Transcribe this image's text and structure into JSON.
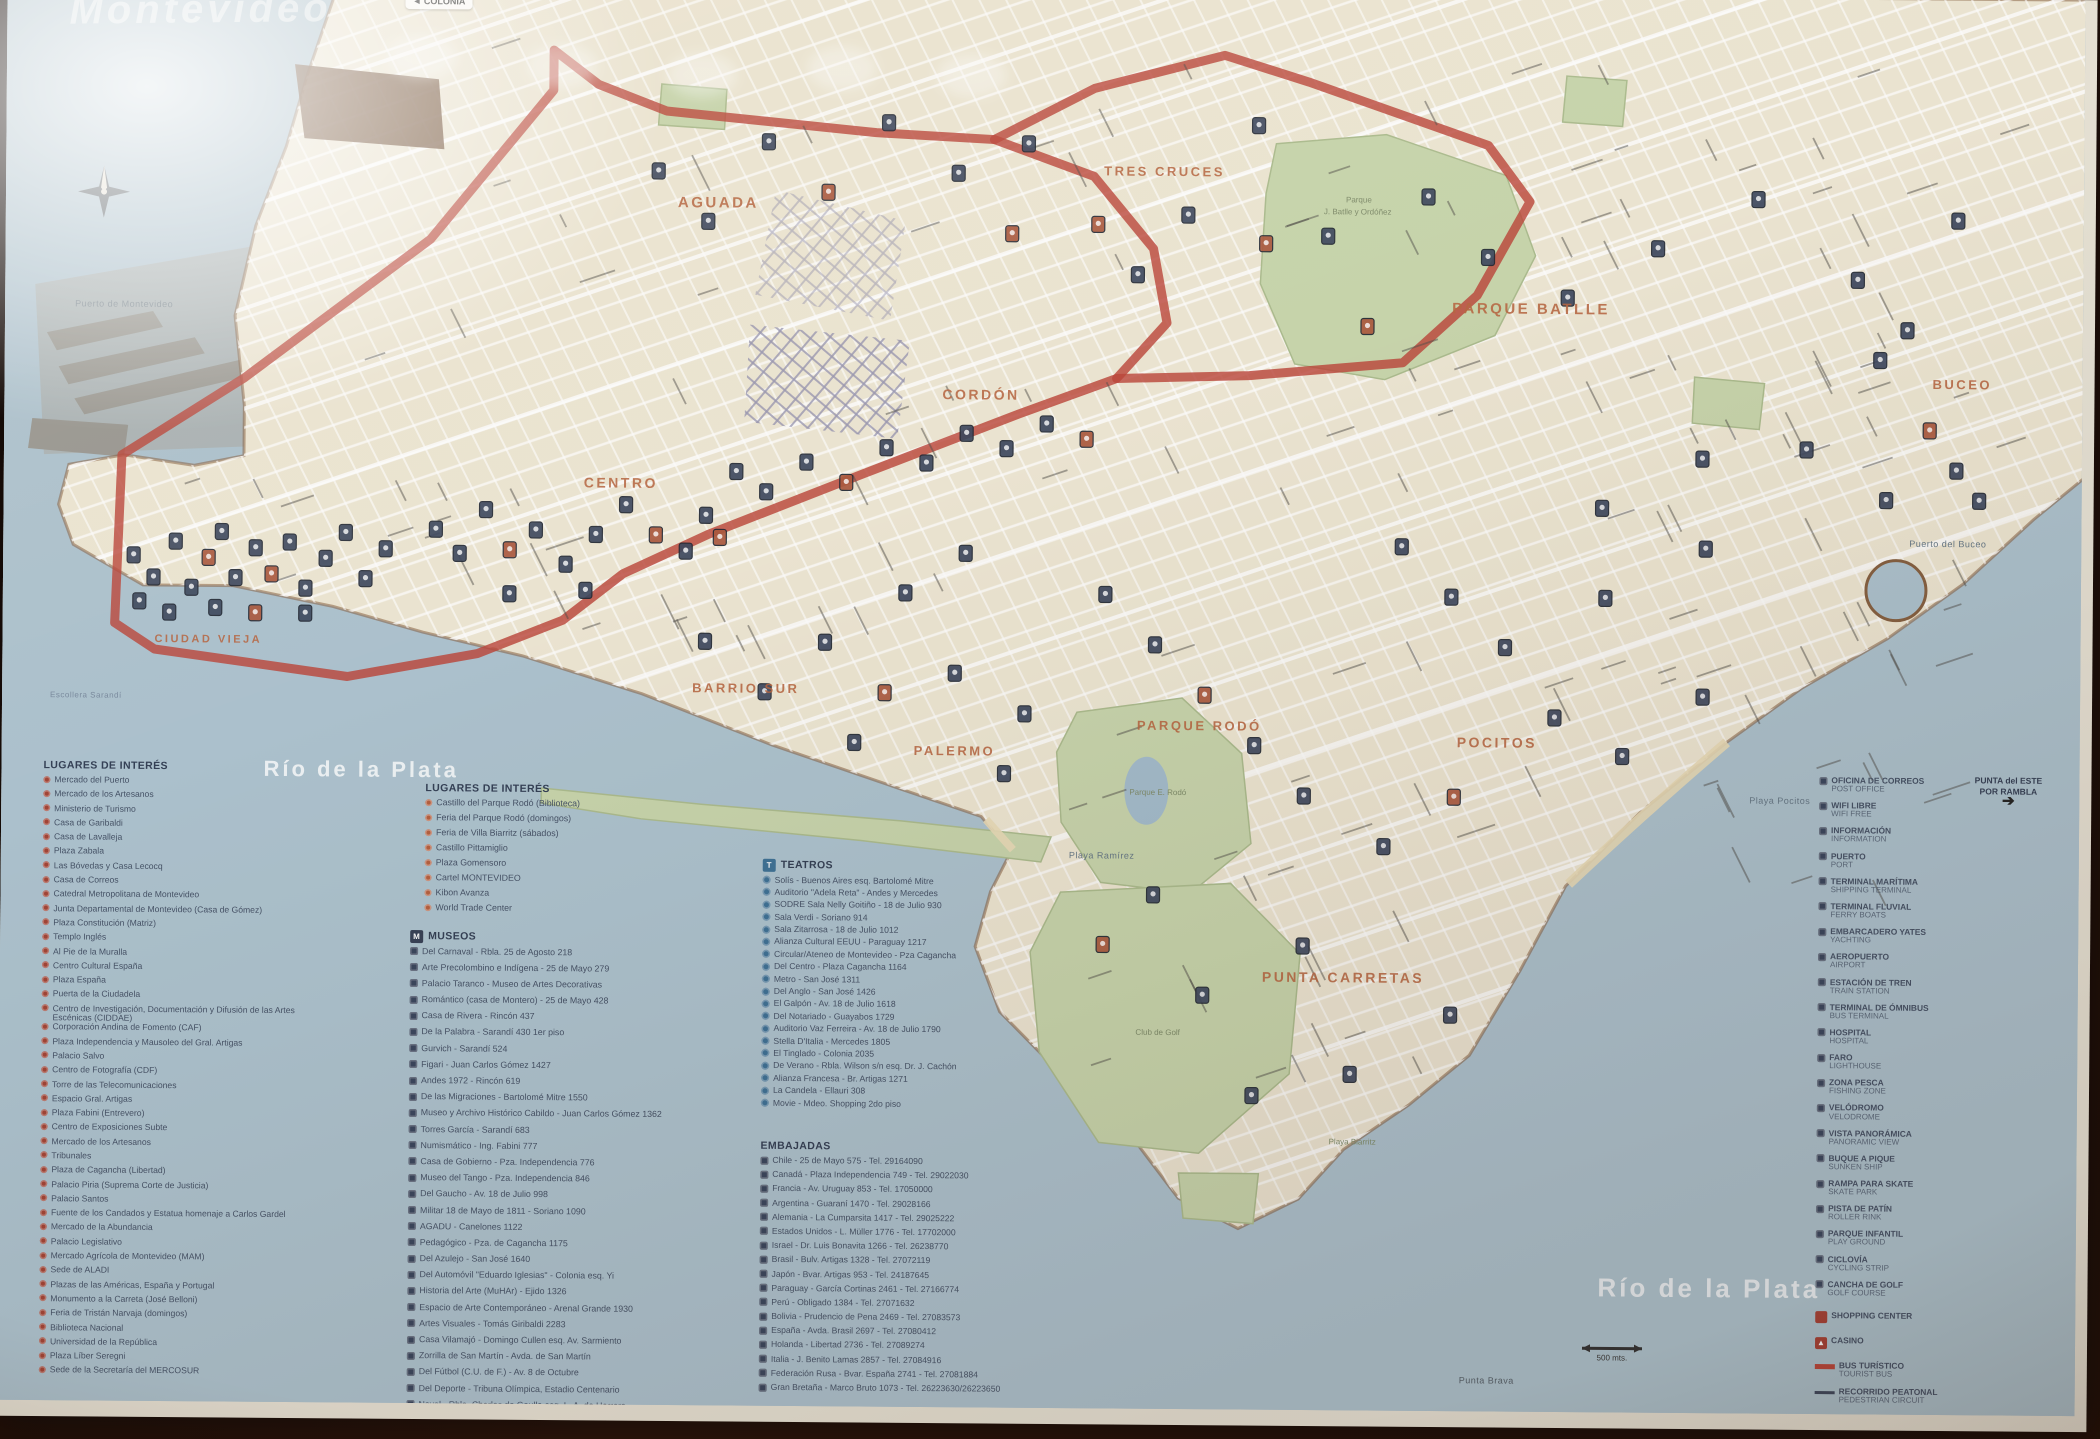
{
  "map": {
    "watermark": "Montevideo",
    "colonia_sign": "◄ COLONIA",
    "corner_note": {
      "line1": "PUNTA del ESTE",
      "line2": "POR RAMBLA",
      "arrow": "➔"
    },
    "scale_label": "500 mts.",
    "route_color": "#cf3a2c",
    "water_color": "#a7c2d1",
    "land_color": "#efe6cd",
    "park_color": "#c5d6a2",
    "district_color": "#c55f30",
    "districts": [
      {
        "text": "AGUADA",
        "x": 672,
        "y": 218,
        "size": 15
      },
      {
        "text": "TRES CRUCES",
        "x": 1098,
        "y": 183,
        "size": 13
      },
      {
        "text": "PARQUE BATLLE",
        "x": 1447,
        "y": 318,
        "size": 15
      },
      {
        "text": "CORDÓN",
        "x": 938,
        "y": 408,
        "size": 14
      },
      {
        "text": "CENTRO",
        "x": 580,
        "y": 499,
        "size": 14
      },
      {
        "text": "CIUDAD VIEJA",
        "x": 152,
        "y": 657,
        "size": 11
      },
      {
        "text": "BARRIO SUR",
        "x": 690,
        "y": 703,
        "size": 13
      },
      {
        "text": "PALERMO",
        "x": 912,
        "y": 764,
        "size": 13
      },
      {
        "text": "PARQUE RODÓ",
        "x": 1135,
        "y": 737,
        "size": 13
      },
      {
        "text": "PUNTA CARRETAS",
        "x": 1262,
        "y": 988,
        "size": 14
      },
      {
        "text": "POCITOS",
        "x": 1455,
        "y": 752,
        "size": 14
      },
      {
        "text": "BUCEO",
        "x": 1928,
        "y": 390,
        "size": 13
      }
    ],
    "water_labels": [
      {
        "text": "Río de la Plata",
        "x": 262,
        "y": 790,
        "size": 22,
        "color": "rgba(255,255,255,.8)",
        "bold": true
      },
      {
        "text": "Río de la Plata",
        "x": 1600,
        "y": 1300,
        "size": 26,
        "color": "rgba(255,255,255,.75)",
        "bold": true
      },
      {
        "text": "Playa Ramírez",
        "x": 1068,
        "y": 866,
        "size": 9,
        "color": "#5d7486"
      },
      {
        "text": "Playa Pocitos",
        "x": 1748,
        "y": 806,
        "size": 9,
        "color": "#5d7486"
      },
      {
        "text": "Puerto del Buceo",
        "x": 1906,
        "y": 548,
        "size": 9,
        "color": "#5d7486"
      },
      {
        "text": "Punta Brava",
        "x": 1462,
        "y": 1388,
        "size": 9,
        "color": "#4c5a66"
      },
      {
        "text": "Escollera Sarandí",
        "x": 48,
        "y": 713,
        "size": 8,
        "color": "#7287a0"
      },
      {
        "text": "Puerto de Montevideo",
        "x": 70,
        "y": 322,
        "size": 9,
        "color": "#74838e"
      }
    ],
    "park_labels": [
      {
        "text": "Parque",
        "x": 1340,
        "y": 208
      },
      {
        "text": "J. Batlle y Ordóñez",
        "x": 1318,
        "y": 220
      },
      {
        "text": "Parque E. Rodó",
        "x": 1128,
        "y": 802
      },
      {
        "text": "Club de Golf",
        "x": 1136,
        "y": 1042
      },
      {
        "text": "Playa Biarritz",
        "x": 1330,
        "y": 1150
      }
    ],
    "markers": [
      [
        130,
        570,
        0
      ],
      [
        150,
        592,
        0
      ],
      [
        172,
        556,
        0
      ],
      [
        188,
        602,
        0
      ],
      [
        205,
        572,
        1
      ],
      [
        218,
        546,
        0
      ],
      [
        232,
        592,
        0
      ],
      [
        252,
        562,
        0
      ],
      [
        268,
        588,
        1
      ],
      [
        286,
        556,
        0
      ],
      [
        302,
        602,
        0
      ],
      [
        322,
        572,
        0
      ],
      [
        342,
        546,
        0
      ],
      [
        362,
        592,
        0
      ],
      [
        382,
        562,
        0
      ],
      [
        212,
        622,
        0
      ],
      [
        252,
        627,
        1
      ],
      [
        302,
        627,
        0
      ],
      [
        166,
        627,
        0
      ],
      [
        136,
        616,
        0
      ],
      [
        432,
        542,
        0
      ],
      [
        456,
        566,
        0
      ],
      [
        482,
        522,
        0
      ],
      [
        506,
        562,
        1
      ],
      [
        532,
        542,
        0
      ],
      [
        562,
        576,
        0
      ],
      [
        592,
        546,
        0
      ],
      [
        622,
        516,
        0
      ],
      [
        652,
        546,
        1
      ],
      [
        682,
        562,
        0
      ],
      [
        702,
        526,
        0
      ],
      [
        582,
        602,
        0
      ],
      [
        506,
        606,
        0
      ],
      [
        716,
        548,
        1
      ],
      [
        732,
        482,
        0
      ],
      [
        762,
        502,
        0
      ],
      [
        802,
        472,
        0
      ],
      [
        842,
        492,
        1
      ],
      [
        882,
        457,
        0
      ],
      [
        922,
        472,
        0
      ],
      [
        962,
        442,
        0
      ],
      [
        1002,
        457,
        0
      ],
      [
        1042,
        432,
        0
      ],
      [
        1082,
        447,
        1
      ],
      [
        652,
        182,
        0
      ],
      [
        702,
        232,
        0
      ],
      [
        762,
        152,
        0
      ],
      [
        822,
        202,
        1
      ],
      [
        882,
        132,
        0
      ],
      [
        952,
        182,
        0
      ],
      [
        1022,
        152,
        0
      ],
      [
        1092,
        232,
        1
      ],
      [
        1132,
        282,
        0
      ],
      [
        1182,
        222,
        0
      ],
      [
        1252,
        132,
        0
      ],
      [
        1006,
        242,
        1
      ],
      [
        1322,
        242,
        0
      ],
      [
        1422,
        202,
        0
      ],
      [
        1482,
        262,
        0
      ],
      [
        1362,
        332,
        1
      ],
      [
        1562,
        302,
        0
      ],
      [
        1652,
        252,
        0
      ],
      [
        1752,
        202,
        0
      ],
      [
        1852,
        282,
        0
      ],
      [
        1952,
        222,
        0
      ],
      [
        1902,
        332,
        0
      ],
      [
        1802,
        452,
        0
      ],
      [
        1882,
        502,
        0
      ],
      [
        1952,
        472,
        0
      ],
      [
        1702,
        552,
        0
      ],
      [
        1602,
        602,
        0
      ],
      [
        1502,
        652,
        0
      ],
      [
        1552,
        722,
        0
      ],
      [
        1620,
        760,
        0
      ],
      [
        1700,
        700,
        0
      ],
      [
        1452,
        802,
        1
      ],
      [
        1382,
        852,
        0
      ],
      [
        702,
        652,
        0
      ],
      [
        762,
        702,
        0
      ],
      [
        822,
        652,
        0
      ],
      [
        882,
        702,
        1
      ],
      [
        952,
        682,
        0
      ],
      [
        1022,
        722,
        0
      ],
      [
        902,
        602,
        0
      ],
      [
        962,
        562,
        0
      ],
      [
        1102,
        602,
        0
      ],
      [
        1152,
        652,
        0
      ],
      [
        1202,
        702,
        1
      ],
      [
        1252,
        752,
        0
      ],
      [
        1302,
        802,
        0
      ],
      [
        1152,
        902,
        0
      ],
      [
        1202,
        1002,
        0
      ],
      [
        1102,
        952,
        1
      ],
      [
        1252,
        1102,
        0
      ],
      [
        1302,
        952,
        0
      ],
      [
        1002,
        782,
        0
      ],
      [
        852,
        752,
        0
      ],
      [
        1875,
        362,
        0
      ],
      [
        1925,
        432,
        1
      ],
      [
        1975,
        502,
        0
      ],
      [
        1598,
        512,
        0
      ],
      [
        1698,
        462,
        0
      ],
      [
        1398,
        552,
        0
      ],
      [
        1448,
        602,
        0
      ],
      [
        1260,
        250,
        1
      ],
      [
        1450,
        1020,
        0
      ],
      [
        1350,
        1080,
        0
      ]
    ]
  },
  "legend": {
    "places1": {
      "title": "LUGARES DE INTERÉS",
      "items": [
        "Mercado del Puerto",
        "Mercado de los Artesanos",
        "Ministerio de Turismo",
        "Casa de Garibaldi",
        "Casa de Lavalleja",
        "Plaza Zabala",
        "Las Bóvedas y Casa Lecocq",
        "Casa de Correos",
        "Catedral Metropolitana de Montevideo",
        "Junta Departamental de Montevideo (Casa de Gómez)",
        "Plaza Constitución (Matriz)",
        "Templo Inglés",
        "Al Pie de la Muralla",
        "Centro Cultural España",
        "Plaza España",
        "Puerta de la Ciudadela",
        "Centro de Investigación, Documentación y Difusión de las Artes Escénicas (CIDDAE)",
        "Corporación Andina de Fomento (CAF)",
        "Plaza Independencia y Mausoleo del Gral. Artigas",
        "Palacio Salvo",
        "Centro de Fotografía (CDF)",
        "Torre de las Telecomunicaciones",
        "Espacio Gral. Artigas",
        "Plaza Fabini (Entrevero)",
        "Centro de Exposiciones Subte",
        "Mercado de los Artesanos",
        "Tribunales",
        "Plaza de Cagancha (Libertad)",
        "Palacio Piria (Suprema Corte de Justicia)",
        "Palacio Santos",
        "Fuente de los Candados y Estatua homenaje a Carlos Gardel",
        "Mercado de la Abundancia",
        "Palacio Legislativo",
        "Mercado Agrícola de Montevideo (MAM)",
        "Sede de ALADI",
        "Plazas de las Américas, España y Portugal",
        "Monumento a la Carreta (José Belloni)",
        "Feria de Tristán Narvaja (domingos)",
        "Biblioteca Nacional",
        "Universidad de la República",
        "Plaza Líber Seregni",
        "Sede de la Secretaría del MERCOSUR"
      ]
    },
    "places2": {
      "title": "LUGARES DE INTERÉS",
      "items": [
        "Castillo del Parque Rodó (Biblioteca)",
        "Feria del Parque Rodó (domingos)",
        "Feria de Villa Biarritz (sábados)",
        "Castillo Pittamiglio",
        "Plaza Gomensoro",
        "Cartel MONTEVIDEO",
        "Kibon Avanza",
        "World Trade Center"
      ]
    },
    "museums": {
      "title": "MUSEOS",
      "items": [
        "Del Carnaval - Rbla. 25 de Agosto 218",
        "Arte Precolombino e Indígena - 25 de Mayo 279",
        "Palacio Taranco - Museo de Artes Decorativas",
        "Romántico (casa de Montero) - 25 de Mayo 428",
        "Casa de Rivera - Rincón 437",
        "De la Palabra - Sarandí 430 1er piso",
        "Gurvich - Sarandí 524",
        "Figari - Juan Carlos Gómez 1427",
        "Andes 1972 - Rincón 619",
        "De las Migraciones - Bartolomé Mitre 1550",
        "Museo y Archivo Histórico Cabildo - Juan Carlos Gómez 1362",
        "Torres García - Sarandí 683",
        "Numismático - Ing. Fabini 777",
        "Casa de Gobierno - Pza. Independencia 776",
        "Museo del Tango - Pza. Independencia 846",
        "Del Gaucho - Av. 18 de Julio 998",
        "Militar 18 de Mayo de 1811 - Soriano 1090",
        "AGADU - Canelones 1122",
        "Pedagógico - Pza. de Cagancha 1175",
        "Del Azulejo - San José 1640",
        "Del Automóvil \"Eduardo Iglesias\" - Colonia esq. Yi",
        "Historia del Arte (MuHAr) - Ejido 1326",
        "Espacio de Arte Contemporáneo - Arenal Grande 1930",
        "Artes Visuales - Tomás Giribaldi 2283",
        "Casa Vilamajó - Domingo Cullen esq. Av. Sarmiento",
        "Zorrilla de San Martín - Avda. de San Martín",
        "Del Fútbol (C.U. de F.) - Av. 8 de Octubre",
        "Del Deporte - Tribuna Olímpica, Estadio Centenario",
        "Naval - Rbla. Charles de Gaulle esq. L. A. de Herrera"
      ]
    },
    "theaters": {
      "title": "TEATROS",
      "items": [
        "Solís - Buenos Aires esq. Bartolomé Mitre",
        "Auditorio \"Adela Reta\" - Andes y Mercedes",
        "SODRE Sala Nelly Goitiño - 18 de Julio 930",
        "Sala Verdi - Soriano 914",
        "Sala Zitarrosa - 18 de Julio 1012",
        "Alianza Cultural EEUU - Paraguay 1217",
        "Circular/Ateneo de Montevideo - Pza Cagancha",
        "Del Centro - Plaza Cagancha 1164",
        "Metro - San José 1311",
        "Del Anglo - San José 1426",
        "El Galpón - Av. 18 de Julio 1618",
        "Del Notariado - Guayabos 1729",
        "Auditorio Vaz Ferreira - Av. 18 de Julio 1790",
        "Stella D'Italia - Mercedes 1805",
        "El Tinglado - Colonia 2035",
        "De Verano - Rbla. Wilson s/n esq. Dr. J. Cachón",
        "Alianza Francesa - Br. Artigas 1271",
        "La Candela - Ellauri 308",
        "Movie - Mdeo. Shopping 2do piso"
      ]
    },
    "embassies": {
      "title": "EMBAJADAS",
      "items": [
        "Chile - 25 de Mayo 575 - Tel. 29164090",
        "Canadá - Plaza Independencia 749 - Tel. 29022030",
        "Francia - Av. Uruguay 853 - Tel. 17050000",
        "Argentina - Guaraní 1470 - Tel. 29028166",
        "Alemania - La Cumparsita 1417 - Tel. 29025222",
        "Estados Unidos - L. Müller 1776 - Tel. 17702000",
        "Israel - Dr. Luis Bonavita 1266 - Tel. 26238770",
        "Brasil - Bulv. Artigas 1328 - Tel. 27072119",
        "Japón - Bvar. Artigas 953 - Tel. 24187645",
        "Paraguay - García Cortinas 2461 - Tel. 27166774",
        "Perú - Obligado 1384 - Tel. 27071632",
        "Bolivia - Prudencio de Pena 2469 - Tel. 27083573",
        "España - Avda. Brasil 2697 - Tel. 27080412",
        "Holanda - Libertad 2736 - Tel. 27089274",
        "Italia - J. Benito Lamas 2857 - Tel. 27084916",
        "Federación Rusa - Bvar. España 2741 - Tel. 27081884",
        "Gran Bretaña - Marco Bruto 1073 - Tel. 26223630/26223650"
      ]
    },
    "services": {
      "items": [
        [
          "OFICINA DE CORREOS",
          "POST OFFICE"
        ],
        [
          "WIFI LIBRE",
          "WIFI FREE"
        ],
        [
          "INFORMACIÓN",
          "INFORMATION"
        ],
        [
          "PUERTO",
          "PORT"
        ],
        [
          "TERMINAL MARÍTIMA",
          "SHIPPING TERMINAL"
        ],
        [
          "TERMINAL FLUVIAL",
          "FERRY BOATS"
        ],
        [
          "EMBARCADERO YATES",
          "YACHTING"
        ],
        [
          "AEROPUERTO",
          "AIRPORT"
        ],
        [
          "ESTACIÓN DE TREN",
          "TRAIN STATION"
        ],
        [
          "TERMINAL DE ÓMNIBUS",
          "BUS TERMINAL"
        ],
        [
          "HOSPITAL",
          "HOSPITAL"
        ],
        [
          "FARO",
          "LIGHTHOUSE"
        ],
        [
          "ZONA PESCA",
          "FISHING ZONE"
        ],
        [
          "VELÓDROMO",
          "VELODROME"
        ],
        [
          "VISTA PANORÁMICA",
          "PANORAMIC VIEW"
        ],
        [
          "BUQUE A PIQUE",
          "SUNKEN SHIP"
        ],
        [
          "RAMPA PARA SKATE",
          "SKATE PARK"
        ],
        [
          "PISTA DE PATÍN",
          "ROLLER RINK"
        ],
        [
          "PARQUE INFANTIL",
          "PLAY GROUND"
        ],
        [
          "CICLOVÍA",
          "CYCLING STRIP"
        ],
        [
          "CANCHA DE GOLF",
          "GOLF COURSE"
        ]
      ],
      "specials": [
        {
          "icon": "sw-red-sq",
          "lines": [
            "SHOPPING CENTER"
          ]
        },
        {
          "icon": "sw-red-tri",
          "lines": [
            "CASINO"
          ]
        },
        {
          "icon": "sw-red-line",
          "lines": [
            "BUS TURÍSTICO",
            "TOURIST BUS"
          ]
        },
        {
          "icon": "sw-navy-line",
          "lines": [
            "RECORRIDO PEATONAL",
            "PEDESTRIAN CIRCUIT"
          ]
        }
      ],
      "footer": [
        "ÁREA AMPLIADA EN MAPA"
      ]
    }
  }
}
